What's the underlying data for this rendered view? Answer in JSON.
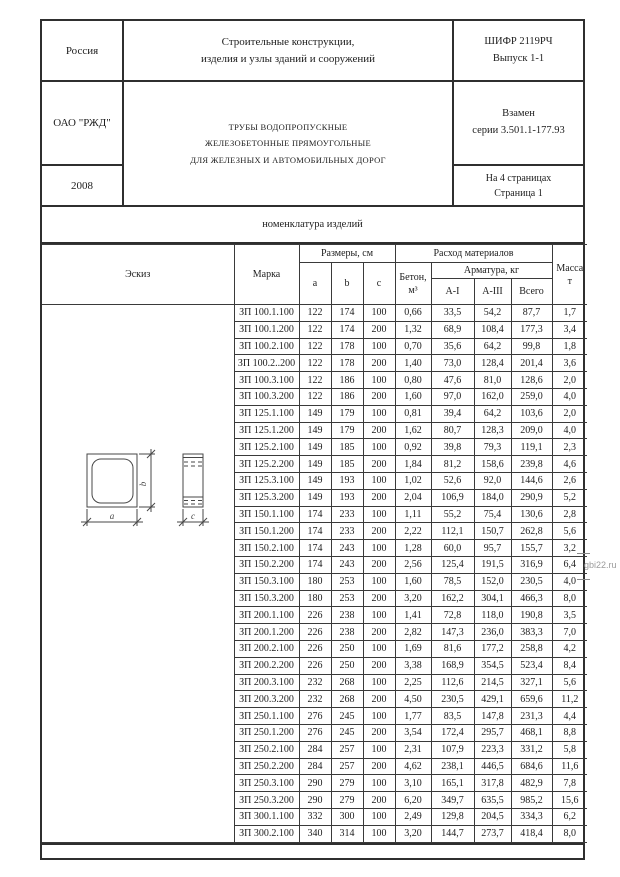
{
  "titleblock": {
    "country": "Россия",
    "series_title": "Строительные конструкции,\nизделия и узлы зданий и сооружений",
    "cipher": "ШИФР 2119РЧ\nВыпуск 1-1",
    "organization": "ОАО \"РЖД\"",
    "product_title": "ТРУБЫ ВОДОПРОПУСКНЫЕ\nЖЕЛЕЗОБЕТОННЫЕ ПРЯМОУГОЛЬНЫЕ\nДЛЯ ЖЕЛЕЗНЫХ И АВТОМОБИЛЬНЫХ ДОРОГ",
    "instead_of": "Взамен\nсерии 3.501.1-177.93",
    "year": "2008",
    "pages": "На 4 страницах\nСтраница 1"
  },
  "band": {
    "title": "номенклатура изделий"
  },
  "table": {
    "headers": {
      "sketch": "Эскиз",
      "mark": "Марка",
      "dimensions": "Размеры, см",
      "a": "a",
      "b": "b",
      "c": "c",
      "materials": "Расход материалов",
      "concrete": "Бетон,\nм³",
      "rebar": "Арматура, кг",
      "ai": "А-I",
      "aiii": "А-III",
      "total": "Всего",
      "mass": "Масса\nт"
    },
    "rows": [
      [
        "ЗП 100.1.100",
        "122",
        "174",
        "100",
        "0,66",
        "33,5",
        "54,2",
        "87,7",
        "1,7"
      ],
      [
        "ЗП 100.1.200",
        "122",
        "174",
        "200",
        "1,32",
        "68,9",
        "108,4",
        "177,3",
        "3,4"
      ],
      [
        "ЗП 100.2.100",
        "122",
        "178",
        "100",
        "0,70",
        "35,6",
        "64,2",
        "99,8",
        "1,8"
      ],
      [
        "ЗП 100.2..200",
        "122",
        "178",
        "200",
        "1,40",
        "73,0",
        "128,4",
        "201,4",
        "3,6"
      ],
      [
        "ЗП 100.3.100",
        "122",
        "186",
        "100",
        "0,80",
        "47,6",
        "81,0",
        "128,6",
        "2,0"
      ],
      [
        "ЗП 100.3.200",
        "122",
        "186",
        "200",
        "1,60",
        "97,0",
        "162,0",
        "259,0",
        "4,0"
      ],
      [
        "ЗП 125.1.100",
        "149",
        "179",
        "100",
        "0,81",
        "39,4",
        "64,2",
        "103,6",
        "2,0"
      ],
      [
        "ЗП 125.1.200",
        "149",
        "179",
        "200",
        "1,62",
        "80,7",
        "128,3",
        "209,0",
        "4,0"
      ],
      [
        "ЗП 125.2.100",
        "149",
        "185",
        "100",
        "0,92",
        "39,8",
        "79,3",
        "119,1",
        "2,3"
      ],
      [
        "ЗП 125.2.200",
        "149",
        "185",
        "200",
        "1,84",
        "81,2",
        "158,6",
        "239,8",
        "4,6"
      ],
      [
        "ЗП 125.3.100",
        "149",
        "193",
        "100",
        "1,02",
        "52,6",
        "92,0",
        "144,6",
        "2,6"
      ],
      [
        "ЗП 125.3.200",
        "149",
        "193",
        "200",
        "2,04",
        "106,9",
        "184,0",
        "290,9",
        "5,2"
      ],
      [
        "ЗП 150.1.100",
        "174",
        "233",
        "100",
        "1,11",
        "55,2",
        "75,4",
        "130,6",
        "2,8"
      ],
      [
        "ЗП 150.1.200",
        "174",
        "233",
        "200",
        "2,22",
        "112,1",
        "150,7",
        "262,8",
        "5,6"
      ],
      [
        "ЗП 150.2.100",
        "174",
        "243",
        "100",
        "1,28",
        "60,0",
        "95,7",
        "155,7",
        "3,2"
      ],
      [
        "ЗП 150.2.200",
        "174",
        "243",
        "200",
        "2,56",
        "125,4",
        "191,5",
        "316,9",
        "6,4"
      ],
      [
        "ЗП 150.3.100",
        "180",
        "253",
        "100",
        "1,60",
        "78,5",
        "152,0",
        "230,5",
        "4,0"
      ],
      [
        "ЗП 150.3.200",
        "180",
        "253",
        "200",
        "3,20",
        "162,2",
        "304,1",
        "466,3",
        "8,0"
      ],
      [
        "ЗП 200.1.100",
        "226",
        "238",
        "100",
        "1,41",
        "72,8",
        "118,0",
        "190,8",
        "3,5"
      ],
      [
        "ЗП 200.1.200",
        "226",
        "238",
        "200",
        "2,82",
        "147,3",
        "236,0",
        "383,3",
        "7,0"
      ],
      [
        "ЗП 200.2.100",
        "226",
        "250",
        "100",
        "1,69",
        "81,6",
        "177,2",
        "258,8",
        "4,2"
      ],
      [
        "ЗП 200.2.200",
        "226",
        "250",
        "200",
        "3,38",
        "168,9",
        "354,5",
        "523,4",
        "8,4"
      ],
      [
        "ЗП 200.3.100",
        "232",
        "268",
        "100",
        "2,25",
        "112,6",
        "214,5",
        "327,1",
        "5,6"
      ],
      [
        "ЗП 200.3.200",
        "232",
        "268",
        "200",
        "4,50",
        "230,5",
        "429,1",
        "659,6",
        "11,2"
      ],
      [
        "ЗП 250.1.100",
        "276",
        "245",
        "100",
        "1,77",
        "83,5",
        "147,8",
        "231,3",
        "4,4"
      ],
      [
        "ЗП 250.1.200",
        "276",
        "245",
        "200",
        "3,54",
        "172,4",
        "295,7",
        "468,1",
        "8,8"
      ],
      [
        "ЗП 250.2.100",
        "284",
        "257",
        "100",
        "2,31",
        "107,9",
        "223,3",
        "331,2",
        "5,8"
      ],
      [
        "ЗП 250.2.200",
        "284",
        "257",
        "200",
        "4,62",
        "238,1",
        "446,5",
        "684,6",
        "11,6"
      ],
      [
        "ЗП 250.3.100",
        "290",
        "279",
        "100",
        "3,10",
        "165,1",
        "317,8",
        "482,9",
        "7,8"
      ],
      [
        "ЗП 250.3.200",
        "290",
        "279",
        "200",
        "6,20",
        "349,7",
        "635,5",
        "985,2",
        "15,6"
      ],
      [
        "ЗП 300.1.100",
        "332",
        "300",
        "100",
        "2,49",
        "129,8",
        "204,5",
        "334,3",
        "6,2"
      ],
      [
        "ЗП 300.2.100",
        "340",
        "314",
        "100",
        "3,20",
        "144,7",
        "273,7",
        "418,4",
        "8,0"
      ]
    ]
  },
  "sketch": {
    "label_a": "a",
    "label_b": "b",
    "label_c": "c"
  },
  "watermark": "gbi22.ru",
  "colors": {
    "border": "#2f2f2f",
    "grid": "#3a3a3a",
    "text": "#1d1d1d",
    "watermark": "#9b9b9b"
  }
}
